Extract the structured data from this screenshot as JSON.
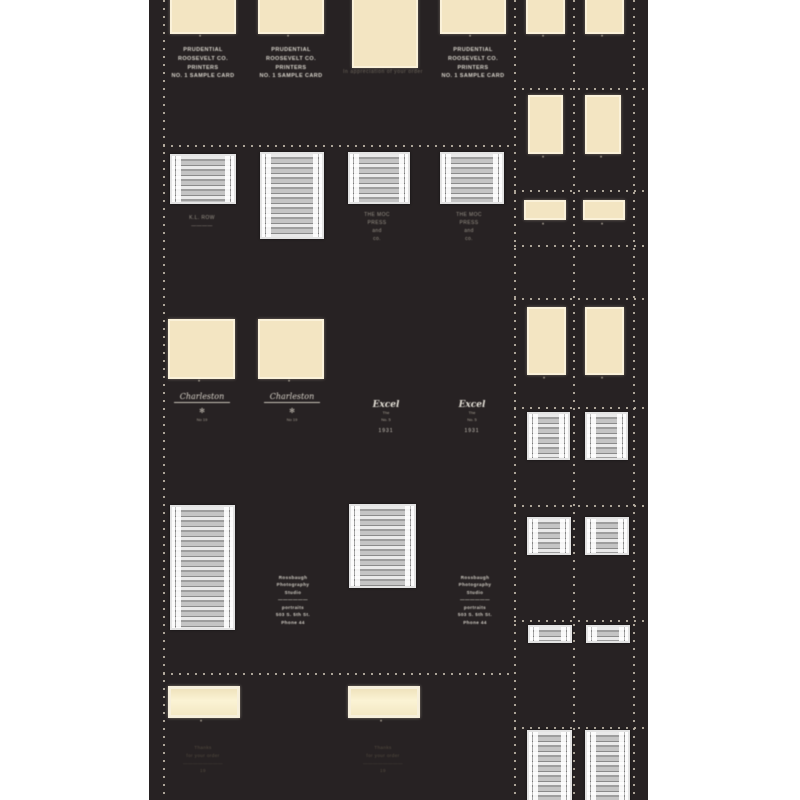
{
  "marks": {
    "dot": "•"
  },
  "colors": {
    "page_bg": "#ffffff",
    "sheet_bg": "#272223",
    "cream_card": "#f3e5c2",
    "cream_card_bright": "#fbf3d4",
    "ruled_gray_light": "#e9e9e9",
    "ruled_gray_dark": "#8a8a8a",
    "guide_dash": "#bab2a4",
    "caption_bright": "#d9d5cc",
    "caption_dim": "#9b958a",
    "caption_ghost": "#554d41"
  },
  "left": {
    "row1": {
      "card_caption": "PRUDENTIAL\nROOSEVELT CO.\nPRINTERS\nNO. 1 SAMPLE CARD",
      "center_caption": "In appreciation of your order"
    },
    "row2": {
      "left_caption": "K.L. ROW\n――――",
      "press_caption": "THE MOC\nPRESS\nand\nco."
    },
    "row3": {
      "signature": "Charleston",
      "ornament": "✻",
      "ornament_sub": "No 19",
      "logo_script": "Excel",
      "logo_sub": "The\nNo. 5",
      "logo_foot": "1931"
    },
    "row4": {
      "studio_block": "Rossbaugh\nPhotography\nStudio\n――――――\nportraits\n503 S. 5th St.\nPhone 44"
    },
    "row5": {
      "ghost_caption": "Thanks\nfor your order\n――――――――\n19"
    }
  }
}
